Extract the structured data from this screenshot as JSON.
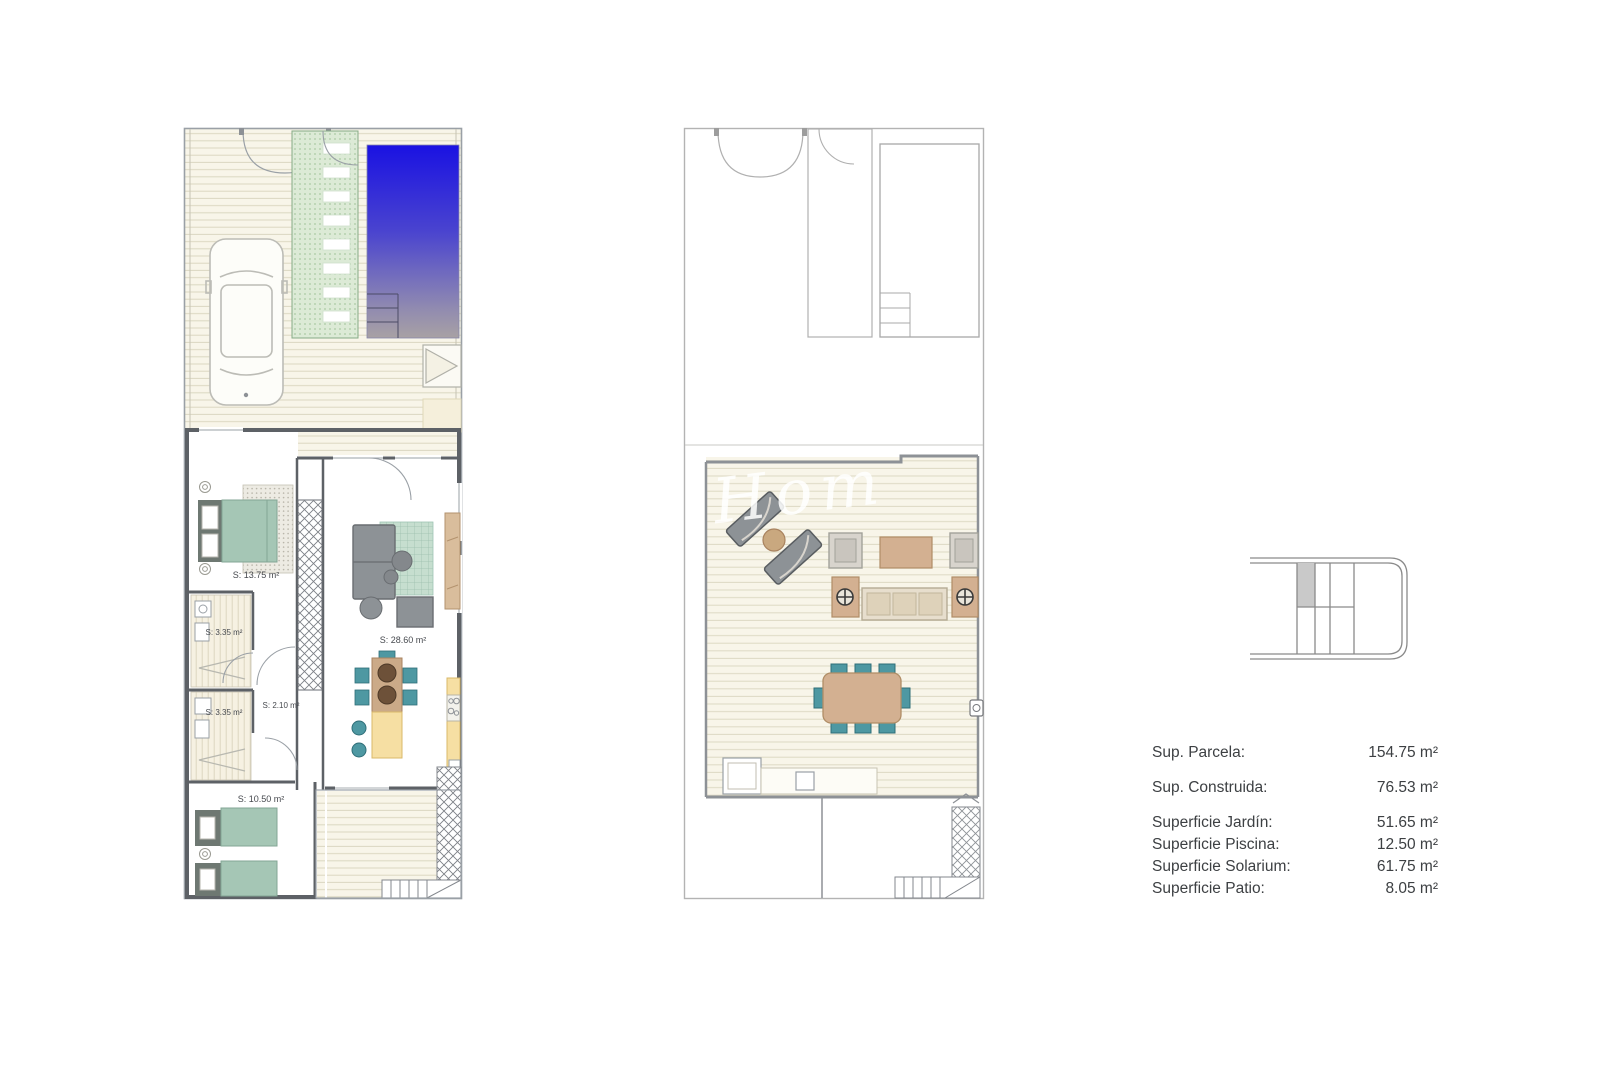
{
  "sheet": {
    "background": "#ffffff",
    "watermark_text": "lm Hom"
  },
  "plans": {
    "ground": {
      "rooms": [
        {
          "name": "bedroom-1",
          "label": "S: 13.75 m²"
        },
        {
          "name": "bathroom-1",
          "label": "S: 3.35 m²"
        },
        {
          "name": "hallway",
          "label": "S: 2.10 m²"
        },
        {
          "name": "bathroom-2",
          "label": "S: 3.35 m²"
        },
        {
          "name": "living-kitchen",
          "label": "S: 28.60 m²"
        },
        {
          "name": "bedroom-2",
          "label": "S: 10.50 m²"
        }
      ]
    }
  },
  "summary": {
    "rows": [
      {
        "label": "Sup. Parcela:",
        "value": "154.75 m²"
      },
      {
        "label": "Sup. Construida:",
        "value": "76.53 m²"
      },
      {
        "label": "Superficie Jardín:",
        "value": "51.65 m²"
      },
      {
        "label": "Superficie Piscina:",
        "value": "12.50 m²"
      },
      {
        "label": "Superficie Solarium:",
        "value": "61.75 m²"
      },
      {
        "label": "Superficie Patio:",
        "value": "8.05 m²"
      }
    ]
  },
  "colors": {
    "pool_top": "#1a12e2",
    "pool_bottom": "#a8a1a4",
    "deck_cream": "#f8f5e9",
    "wall_dark": "#5d6166",
    "furniture_teal": "#a5c6b5",
    "chair_teal": "#4e98a2",
    "wood_tan": "#cbaa88",
    "counter_yellow": "#f6dfa3",
    "path_green": "#dcead6",
    "outline_gray": "#9aa0a6",
    "text_gray": "#3d4043"
  }
}
